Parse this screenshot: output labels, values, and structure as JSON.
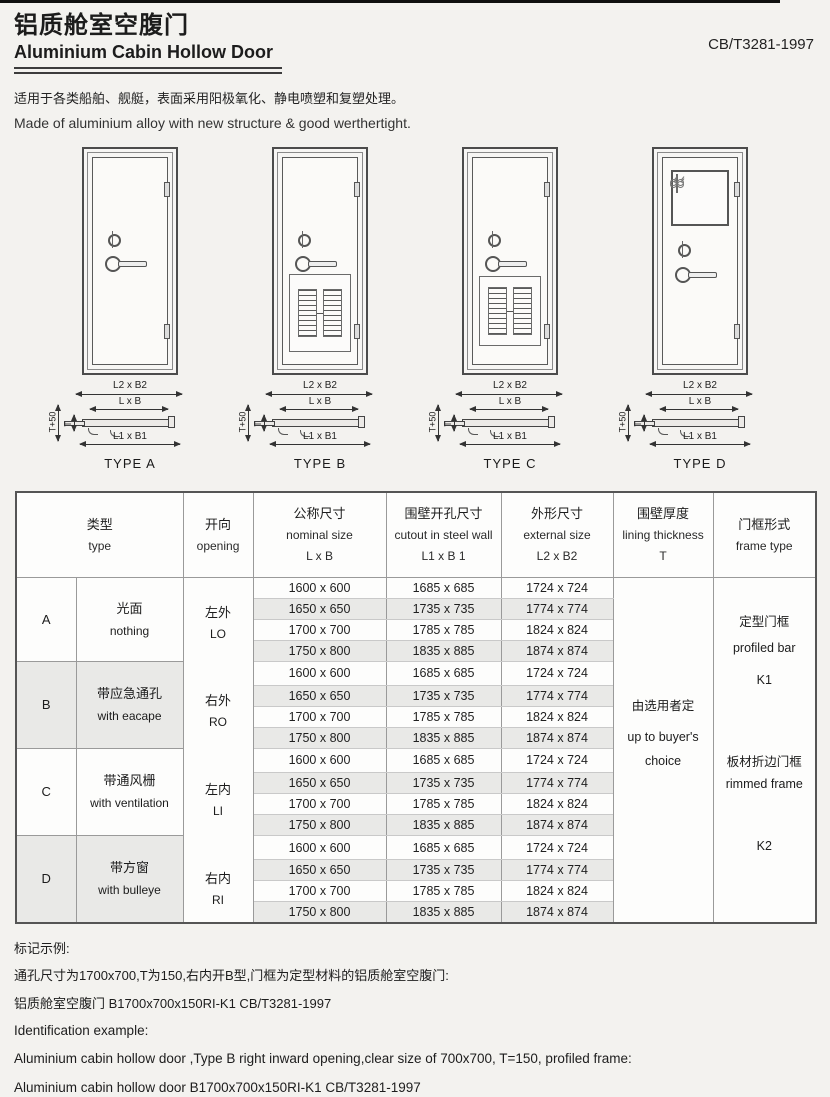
{
  "page": {
    "title_zh": "铝质舱室空腹门",
    "title_en": "Aluminium Cabin Hollow Door",
    "standard": "CB/T3281-1997",
    "desc_zh": "适用于各类船舶、舰艇，表面采用阳极氧化、静电喷塑和复塑处理。",
    "desc_en": "Made of aluminium alloy with new structure & good werthertight."
  },
  "diagrams": {
    "dim_external": "L2 x B2",
    "dim_nominal": "L x B",
    "dim_cutout": "L1 x B1",
    "dim_t50": "T+50",
    "dim_t": "T",
    "types": [
      {
        "label": "TYPE A",
        "feature": "plain"
      },
      {
        "label": "TYPE B",
        "feature": "louver"
      },
      {
        "label": "TYPE C",
        "feature": "louver"
      },
      {
        "label": "TYPE D",
        "feature": "window"
      }
    ]
  },
  "table": {
    "headers": {
      "type_zh": "类型",
      "type_en": "type",
      "opening_zh": "开向",
      "opening_en": "opening",
      "nominal_zh": "公称尺寸",
      "nominal_en": "nominal size",
      "nominal_sub": "L x B",
      "cutout_zh": "围壁开孔尺寸",
      "cutout_en": "cutout in steel wall",
      "cutout_sub": "L1 x B 1",
      "external_zh": "外形尺寸",
      "external_en": "external  size",
      "external_sub": "L2 x B2",
      "lining_zh": "围壁厚度",
      "lining_en": "lining thickness",
      "lining_sub": "T",
      "frame_zh": "门框形式",
      "frame_en": "frame type"
    },
    "groups": [
      {
        "letter": "A",
        "desc_zh": "光面",
        "desc_en": "nothing"
      },
      {
        "letter": "B",
        "desc_zh": "带应急通孔",
        "desc_en": "with eacape"
      },
      {
        "letter": "C",
        "desc_zh": "带通风栅",
        "desc_en": "with ventilation"
      },
      {
        "letter": "D",
        "desc_zh": "带方窗",
        "desc_en": "with bulleye"
      }
    ],
    "openings": [
      {
        "zh": "左外",
        "en": "LO"
      },
      {
        "zh": "右外",
        "en": "RO"
      },
      {
        "zh": "左内",
        "en": "LI"
      },
      {
        "zh": "右内",
        "en": "RI"
      }
    ],
    "sizes": [
      {
        "nominal": "1600 x 600",
        "cutout": "1685 x 685",
        "external": "1724 x 724"
      },
      {
        "nominal": "1650 x 650",
        "cutout": "1735 x 735",
        "external": "1774 x 774"
      },
      {
        "nominal": "1700 x 700",
        "cutout": "1785 x 785",
        "external": "1824 x 824"
      },
      {
        "nominal": "1750 x 800",
        "cutout": "1835 x 885",
        "external": "1874 x 874"
      }
    ],
    "lining": {
      "zh": "由选用者定",
      "en1": "up to buyer's",
      "en2": "choice"
    },
    "frames": {
      "profiled_zh": "定型门框",
      "profiled_en": "profiled bar",
      "k1": "K1",
      "rimmed_zh": "板材折边门框",
      "rimmed_en": "rimmed frame",
      "k2": "K2"
    }
  },
  "example": {
    "zh_title": "标记示例:",
    "zh_line1": "通孔尺寸为1700x700,T为150,右内开B型,门框为定型材料的铝质舱室空腹门:",
    "zh_line2": "铝质舱室空腹门 B1700x700x150RI-K1 CB/T3281-1997",
    "en_title": "Identification example:",
    "en_line1": "Aluminium cabin hollow door ,Type B right inward opening,clear size of 700x700, T=150, profiled frame:",
    "en_line2": "Aluminium cabin hollow door B1700x700x150RI-K1 CB/T3281-1997"
  }
}
